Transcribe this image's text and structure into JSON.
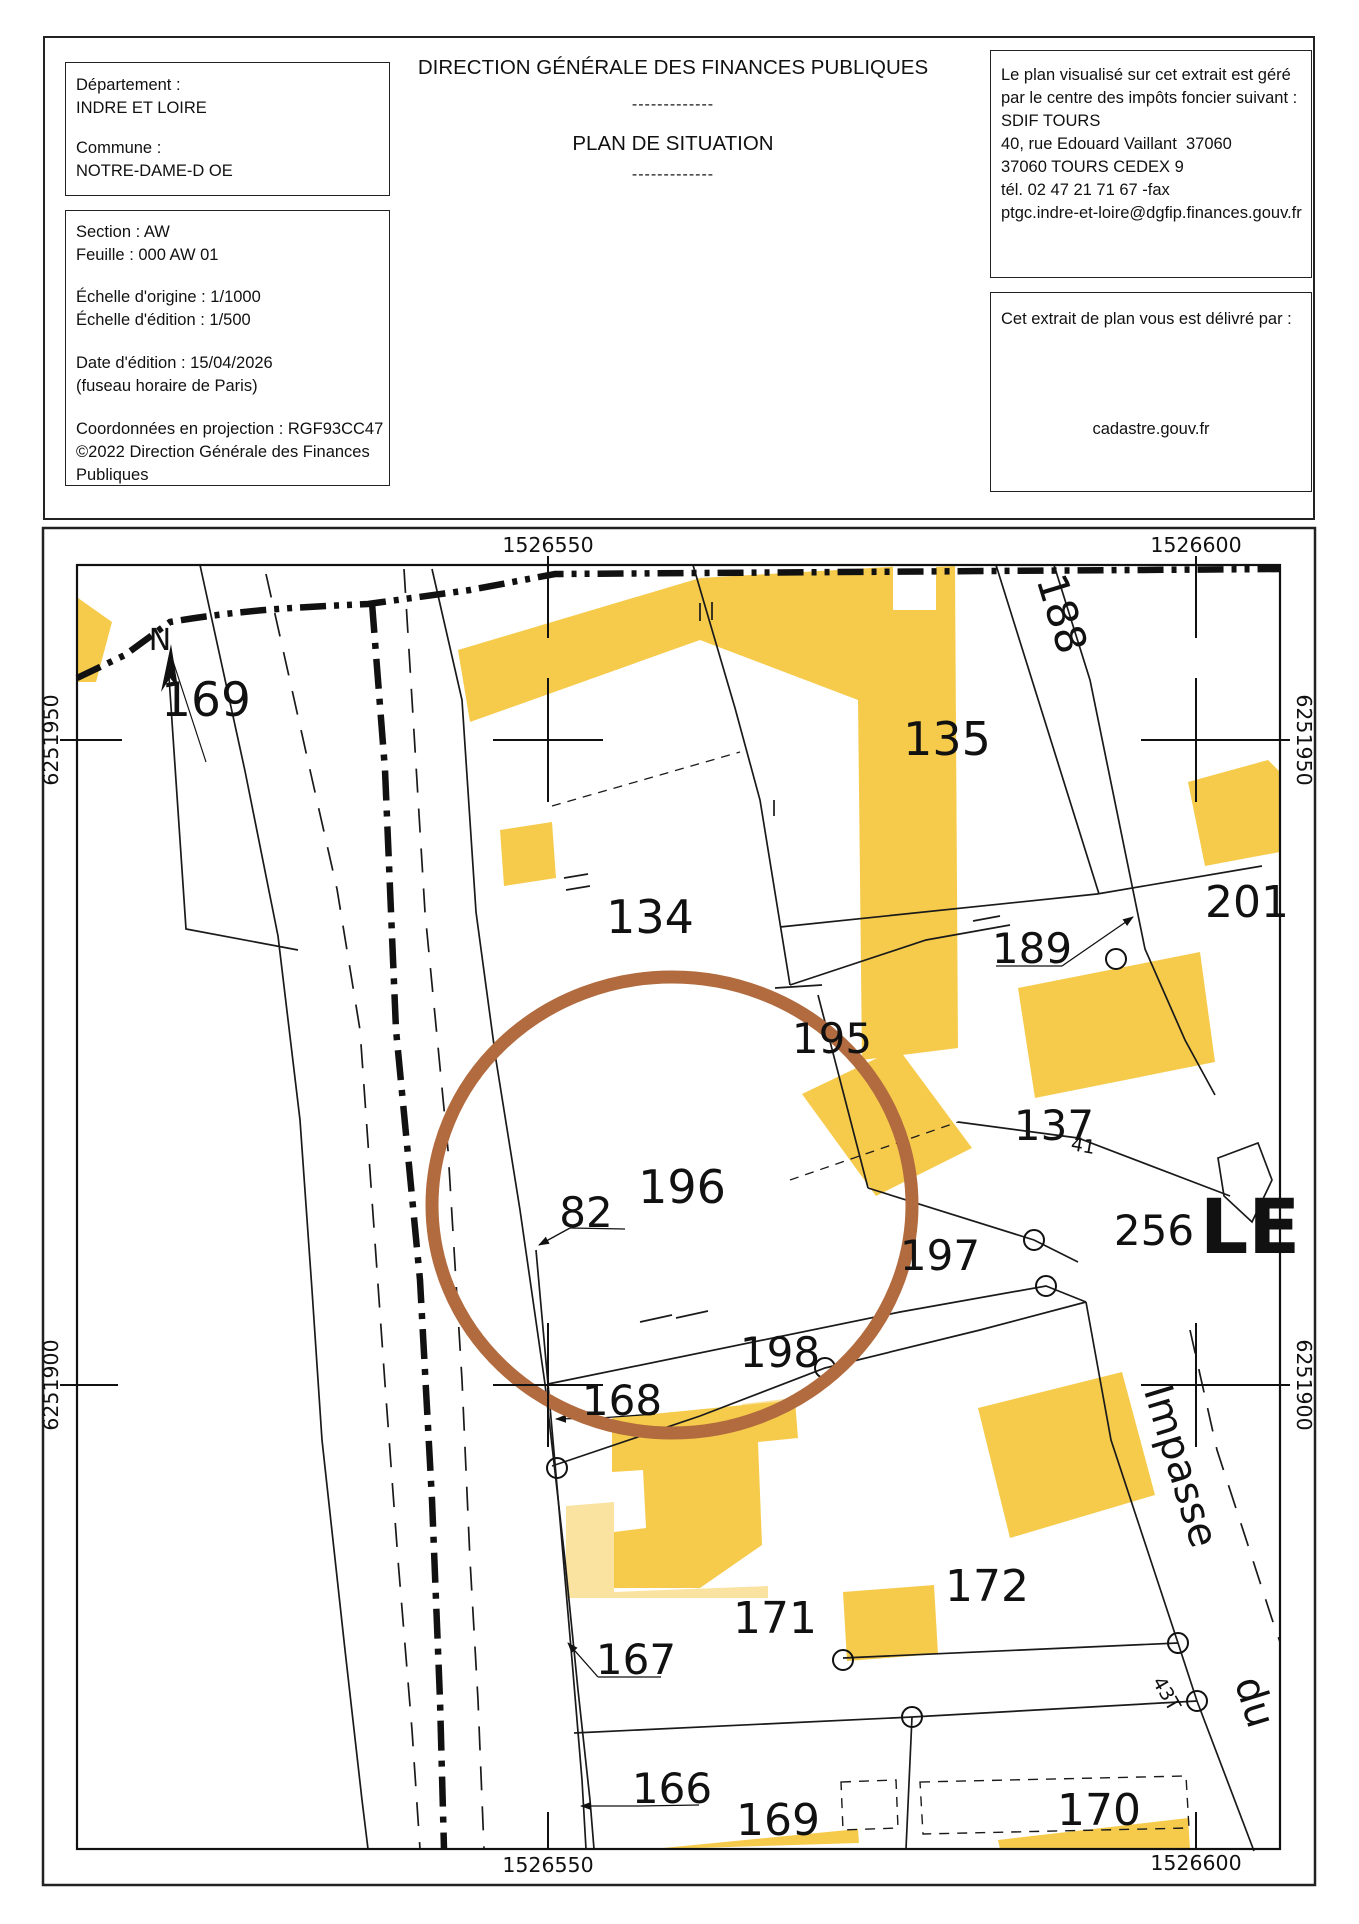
{
  "header": {
    "title": "DIRECTION GÉNÉRALE DES FINANCES PUBLIQUES",
    "separator1": "-------------",
    "subtitle": "PLAN DE SITUATION",
    "separator2": "-------------",
    "left_box1": {
      "departement_label": "Département :",
      "departement": "INDRE ET LOIRE",
      "commune_label": "Commune :",
      "commune": "NOTRE-DAME-D OE"
    },
    "left_box2": {
      "section": "Section : AW",
      "feuille": "Feuille : 000 AW 01",
      "echelle_origine": "Échelle d'origine : 1/1000",
      "echelle_edition": "Échelle d'édition : 1/500",
      "date_edition": "Date d'édition : 15/04/2026",
      "fuseau": "(fuseau horaire de Paris)",
      "projection": "Coordonnées en projection : RGF93CC47",
      "copyright_line1": "©2022 Direction Générale des Finances",
      "copyright_line2": "Publiques"
    },
    "right_box1": {
      "line1": "Le plan visualisé sur cet extrait est géré",
      "line2": "par le centre des impôts foncier suivant :",
      "line3": "SDIF TOURS",
      "line4": "40, rue Edouard Vaillant  37060",
      "line5": "37060 TOURS CEDEX 9",
      "line6": "tél. 02 47 21 71 67 -fax",
      "line7": "ptgc.indre-et-loire@dgfip.finances.gouv.fr"
    },
    "right_box2": {
      "intro": "Cet extrait de plan vous est délivré par :",
      "site": "cadastre.gouv.fr"
    }
  },
  "map": {
    "colors": {
      "building": "#F6CB4C",
      "building_light": "#FAE3A1",
      "highlight_circle": "#B26B3E",
      "line": "#1a1a1a"
    },
    "grid_labels": [
      {
        "t": "1526550",
        "x": 548,
        "y": 552,
        "r": 0
      },
      {
        "t": "1526600",
        "x": 1196,
        "y": 552,
        "r": 0
      },
      {
        "t": "1526550",
        "x": 548,
        "y": 1872,
        "r": 0
      },
      {
        "t": "1526600",
        "x": 1196,
        "y": 1870,
        "r": 0
      },
      {
        "t": "6251950",
        "x": 58,
        "y": 740,
        "r": -90
      },
      {
        "t": "6251900",
        "x": 58,
        "y": 1385,
        "r": -90
      },
      {
        "t": "6251950",
        "x": 1297,
        "y": 740,
        "r": 90
      },
      {
        "t": "6251900",
        "x": 1297,
        "y": 1385,
        "r": 90
      }
    ],
    "parcel_labels": [
      {
        "t": "N",
        "x": 160,
        "y": 650,
        "s": 30,
        "r": 0,
        "b": false
      },
      {
        "t": "169",
        "x": 206,
        "y": 716,
        "s": 47,
        "r": 0,
        "b": false
      },
      {
        "t": "188",
        "x": 1048,
        "y": 618,
        "s": 42,
        "r": 73,
        "b": false
      },
      {
        "t": "135",
        "x": 947,
        "y": 755,
        "s": 46,
        "r": 0,
        "b": false
      },
      {
        "t": "134",
        "x": 650,
        "y": 933,
        "s": 46,
        "r": 0,
        "b": false
      },
      {
        "t": "201",
        "x": 1247,
        "y": 917,
        "s": 44,
        "r": 0,
        "b": false
      },
      {
        "t": "189",
        "x": 1032,
        "y": 963,
        "s": 42,
        "r": 0,
        "b": false
      },
      {
        "t": "195",
        "x": 832,
        "y": 1053,
        "s": 42,
        "r": 0,
        "b": false
      },
      {
        "t": "137",
        "x": 1054,
        "y": 1140,
        "s": 42,
        "r": 0,
        "b": false
      },
      {
        "t": "41",
        "x": 1082,
        "y": 1152,
        "s": 19,
        "r": 10,
        "b": false
      },
      {
        "t": "82",
        "x": 586,
        "y": 1227,
        "s": 42,
        "r": 0,
        "b": false
      },
      {
        "t": "196",
        "x": 682,
        "y": 1203,
        "s": 46,
        "r": 0,
        "b": false
      },
      {
        "t": "256",
        "x": 1154,
        "y": 1245,
        "s": 42,
        "r": 0,
        "b": false
      },
      {
        "t": "LE",
        "x": 1250,
        "y": 1253,
        "s": 76,
        "r": 0,
        "b": true
      },
      {
        "t": "197",
        "x": 940,
        "y": 1270,
        "s": 42,
        "r": 0,
        "b": false
      },
      {
        "t": "198",
        "x": 780,
        "y": 1367,
        "s": 42,
        "r": 0,
        "b": false
      },
      {
        "t": "168",
        "x": 622,
        "y": 1415,
        "s": 42,
        "r": 0,
        "b": false
      },
      {
        "t": "Impasse",
        "x": 1168,
        "y": 1470,
        "s": 40,
        "r": 73,
        "b": false
      },
      {
        "t": "172",
        "x": 987,
        "y": 1601,
        "s": 44,
        "r": 0,
        "b": false
      },
      {
        "t": "171",
        "x": 775,
        "y": 1633,
        "s": 44,
        "r": 0,
        "b": false
      },
      {
        "t": "167",
        "x": 636,
        "y": 1674,
        "s": 42,
        "r": 0,
        "b": false
      },
      {
        "t": "43T",
        "x": 1161,
        "y": 1697,
        "s": 19,
        "r": 60,
        "b": false
      },
      {
        "t": "du",
        "x": 1242,
        "y": 1706,
        "s": 40,
        "r": 73,
        "b": false
      },
      {
        "t": "166",
        "x": 672,
        "y": 1803,
        "s": 42,
        "r": 0,
        "b": false
      },
      {
        "t": "169",
        "x": 778,
        "y": 1835,
        "s": 44,
        "r": 0,
        "b": false
      },
      {
        "t": "170",
        "x": 1099,
        "y": 1825,
        "s": 44,
        "r": 0,
        "b": false
      }
    ]
  }
}
